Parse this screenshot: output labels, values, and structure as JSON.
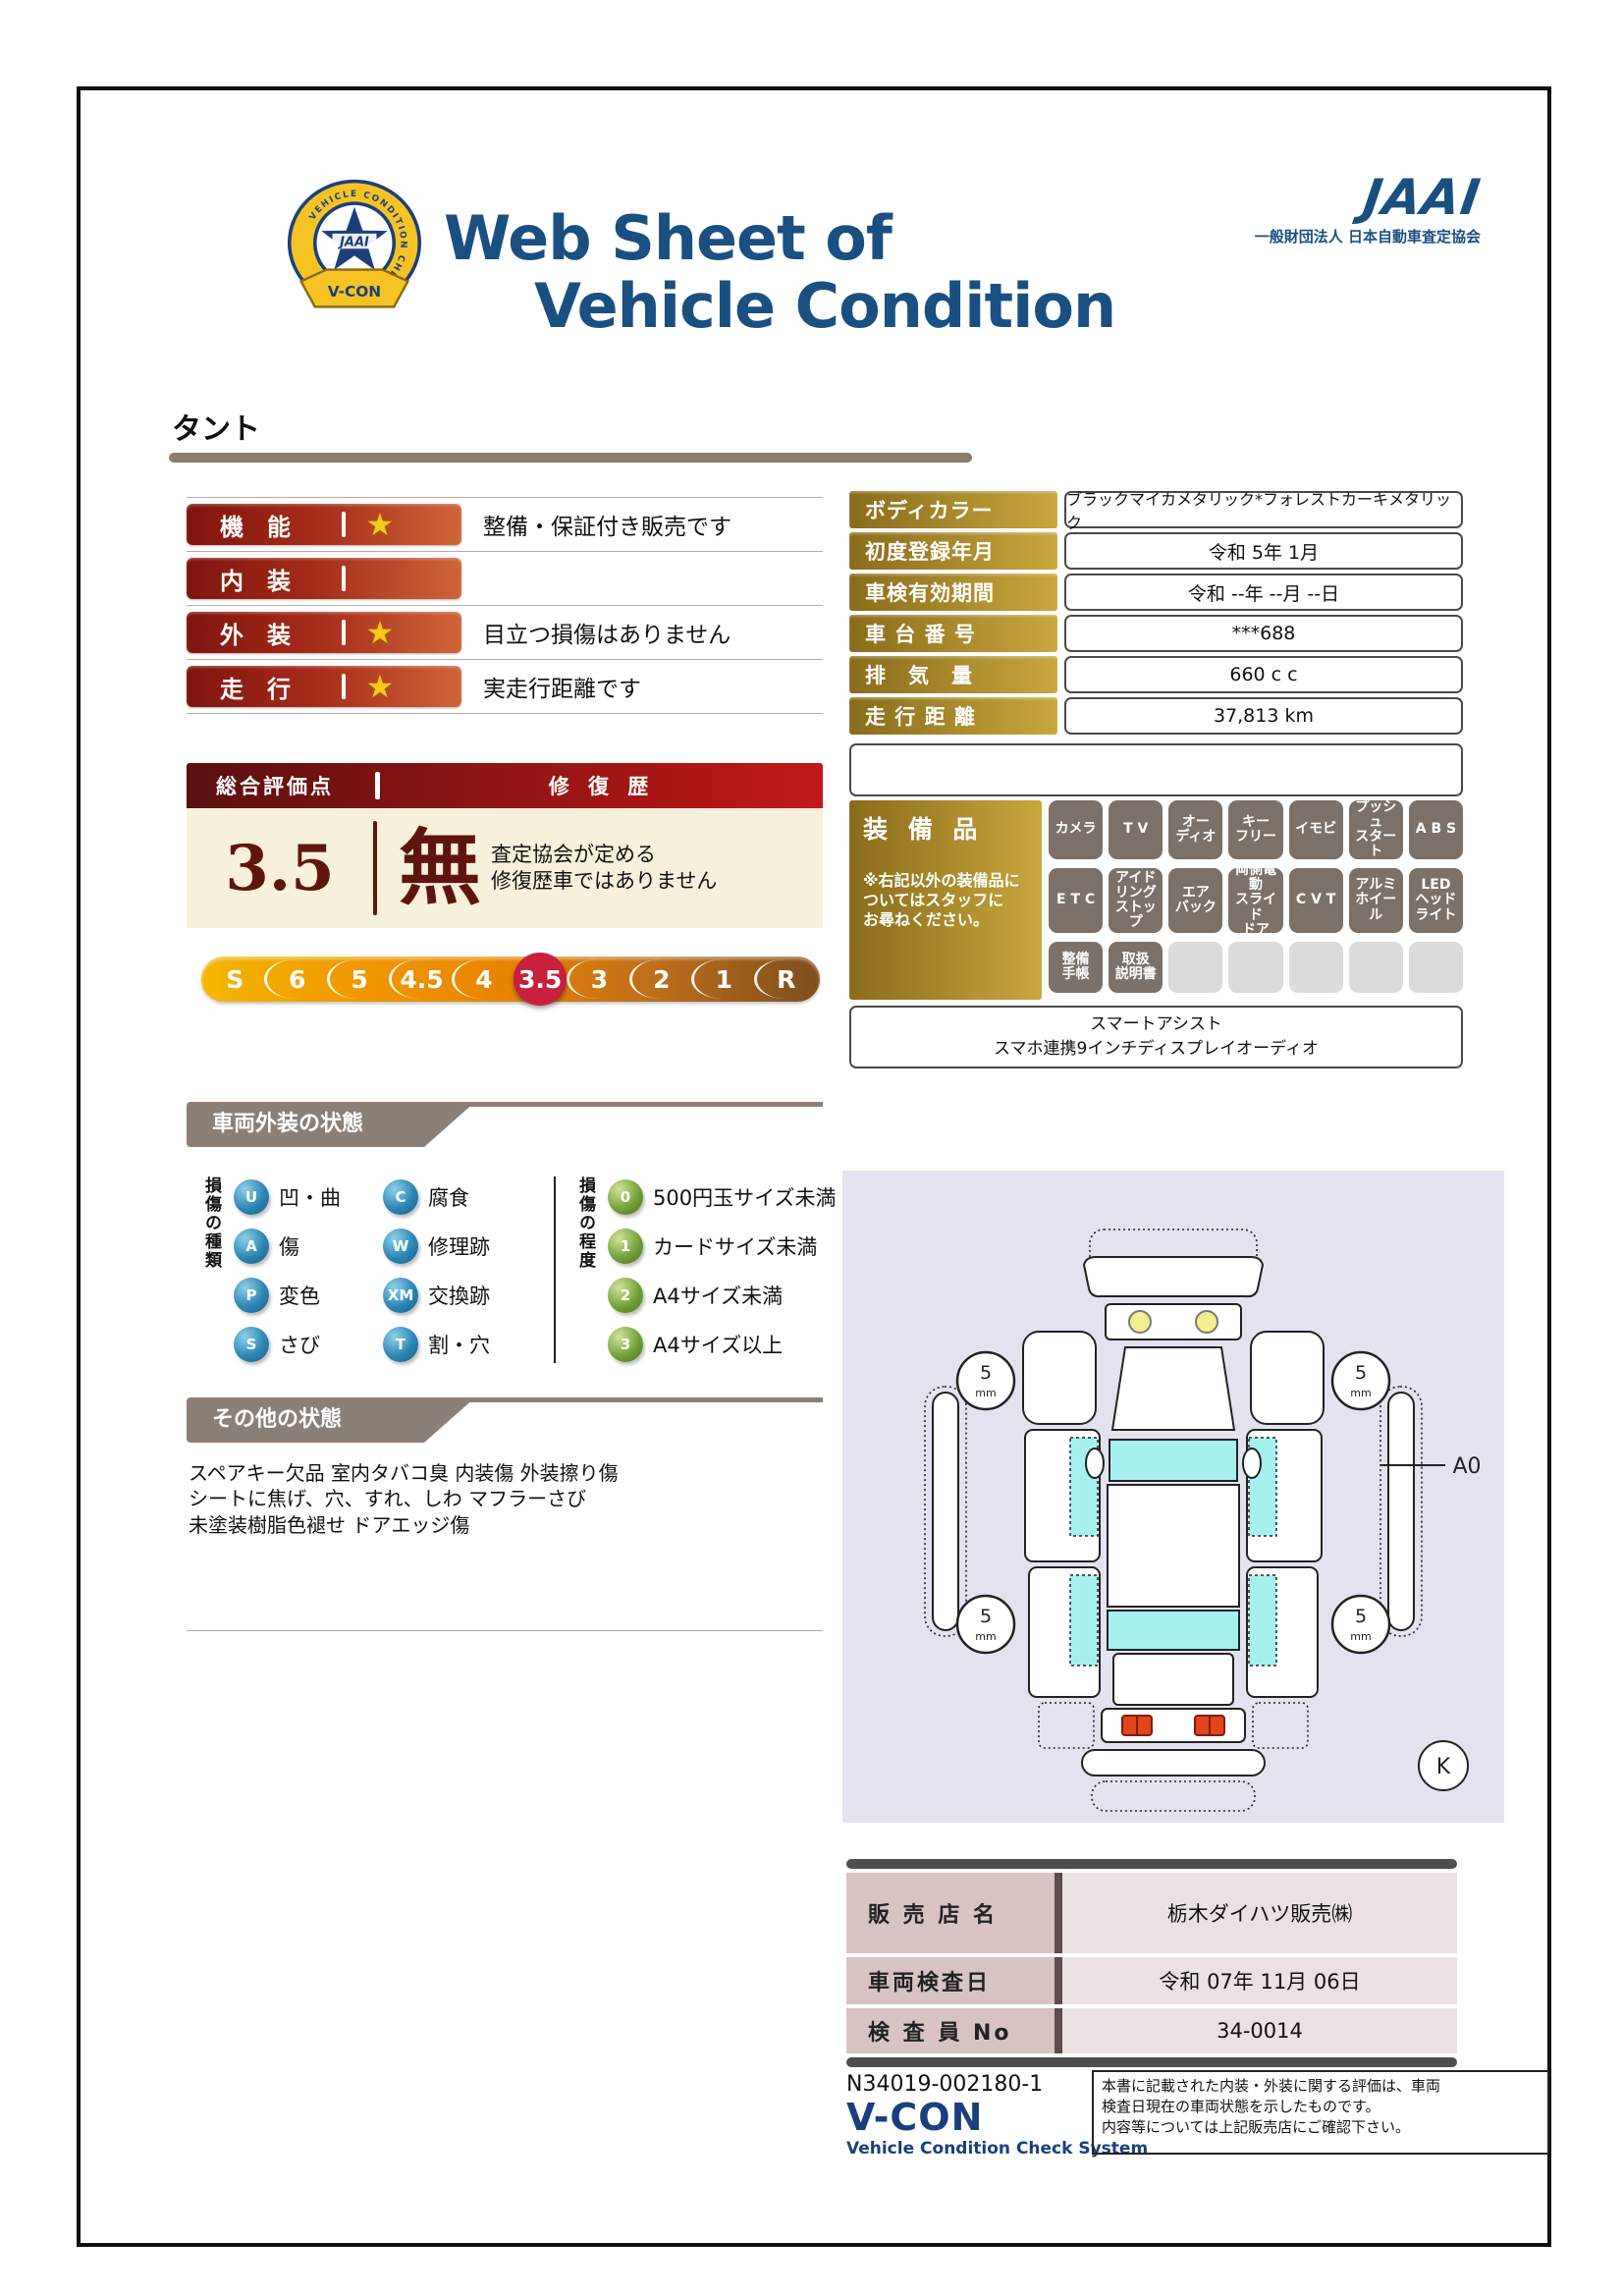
{
  "header": {
    "title_line1": "Web Sheet of",
    "title_line2": "Vehicle Condition",
    "vcon_badge": {
      "jaai": "JAAI",
      "ring_text": "VEHICLE CONDITION CHECK SYSTEM",
      "ribbon": "V-CON"
    },
    "jaai_wordmark": "JAAI",
    "jaai_org": "一般財団法人 日本自動車査定協会"
  },
  "vehicle_name": "タント",
  "ratings": [
    {
      "label": "機　能",
      "star": true,
      "note": "整備・保証付き販売です"
    },
    {
      "label": "内　装",
      "star": false,
      "note": ""
    },
    {
      "label": "外　装",
      "star": true,
      "note": "目立つ損傷はありません"
    },
    {
      "label": "走　行",
      "star": true,
      "note": "実走行距離です"
    }
  ],
  "overall": {
    "header_left": "総合評価点",
    "header_right": "修 復 歴",
    "score": "3.5",
    "repair_mark": "無",
    "repair_note_line1": "査定協会が定める",
    "repair_note_line2": "修復歴車ではありません"
  },
  "scale": {
    "items": [
      {
        "label": "S"
      },
      {
        "label": "6"
      },
      {
        "label": "5"
      },
      {
        "label": "4.5"
      },
      {
        "label": "4"
      },
      {
        "label": "3.5",
        "selected": true
      },
      {
        "label": "3"
      },
      {
        "label": "2"
      },
      {
        "label": "1"
      },
      {
        "label": "R"
      }
    ]
  },
  "info_table": {
    "rows": [
      {
        "label": "ボディカラー",
        "value": "ブラックマイカメタリック*フォレストカーキメタリック"
      },
      {
        "label": "初度登録年月",
        "value": "令和 5年 1月"
      },
      {
        "label": "車検有効期間",
        "value": "令和 --年 --月 --日"
      },
      {
        "label": "車 台 番 号",
        "value": "***688"
      },
      {
        "label": "排　気　量",
        "value": "660 c c"
      },
      {
        "label": "走 行 距 離",
        "value": "37,813 km"
      }
    ]
  },
  "equipment": {
    "title": "装 備 品",
    "note": "※右記以外の装備品に\nついてはスタッフに\nお尋ねください。",
    "badges": [
      {
        "label": "カメラ",
        "active": true
      },
      {
        "label": "T V",
        "active": true
      },
      {
        "label": "オー\nディオ",
        "active": true
      },
      {
        "label": "キー\nフリー",
        "active": true
      },
      {
        "label": "イモビ",
        "active": true
      },
      {
        "label": "プッシュ\nスタート",
        "active": true
      },
      {
        "label": "A B S",
        "active": true
      },
      {
        "label": "E T C",
        "active": true
      },
      {
        "label": "アイド\nリング\nストップ",
        "active": true
      },
      {
        "label": "エア\nバック",
        "active": true
      },
      {
        "label": "両側電動\nスライド\nドア",
        "active": true
      },
      {
        "label": "C V T",
        "active": true
      },
      {
        "label": "アルミ\nホイール",
        "active": true
      },
      {
        "label": "LED\nヘッド\nライト",
        "active": true
      },
      {
        "label": "整備\n手帳",
        "active": true
      },
      {
        "label": "取扱\n説明書",
        "active": true
      },
      {
        "label": "",
        "active": false
      },
      {
        "label": "",
        "active": false
      },
      {
        "label": "",
        "active": false
      },
      {
        "label": "",
        "active": false
      },
      {
        "label": "",
        "active": false
      }
    ],
    "extra_line1": "スマートアシスト",
    "extra_line2": "スマホ連携9インチディスプレイオーディオ"
  },
  "exterior": {
    "section_title": "車両外装の状態",
    "type_axis": "損傷の種類",
    "types": [
      {
        "code": "U",
        "label": "凹・曲"
      },
      {
        "code": "C",
        "label": "腐食"
      },
      {
        "code": "A",
        "label": "傷"
      },
      {
        "code": "W",
        "label": "修理跡"
      },
      {
        "code": "P",
        "label": "変色"
      },
      {
        "code": "XM",
        "label": "交換跡"
      },
      {
        "code": "S",
        "label": "さび"
      },
      {
        "code": "T",
        "label": "割・穴"
      }
    ],
    "degree_axis": "損傷の程度",
    "degrees": [
      {
        "code": "0",
        "label": "500円玉サイズ未満"
      },
      {
        "code": "1",
        "label": "カードサイズ未満"
      },
      {
        "code": "2",
        "label": "A4サイズ未満"
      },
      {
        "code": "3",
        "label": "A4サイズ以上"
      }
    ]
  },
  "other": {
    "section_title": "その他の状態",
    "lines": [
      "スペアキー欠品 室内タバコ臭 内装傷 外装擦り傷",
      "シートに焦げ、穴、すれ、しわ マフラーさび",
      "未塗装樹脂色褪せ ドアエッジ傷"
    ]
  },
  "diagram": {
    "tire_size": "5",
    "tire_unit": "mm",
    "damage_marker": "A0",
    "key_mark": "K"
  },
  "dealer": {
    "rows": [
      {
        "label": "販 売 店 名",
        "value": "栃木ダイハツ販売㈱"
      },
      {
        "label": "車両検査日",
        "value": "令和 07年 11月 06日"
      },
      {
        "label": "検 査 員 No",
        "value": "34-0014"
      }
    ]
  },
  "footer": {
    "doc_number": "N34019-002180-1",
    "vcon": "V-CON",
    "vcon_sub": "Vehicle Condition Check System",
    "disclaimer": "本書に記載された内装・外装に関する評価は、車両\n検査日現在の車両状態を示したものです。\n内容等については上記販売店にご確認下さい。"
  },
  "colors": {
    "navy": "#1a4f82",
    "maroon": "#7f150e",
    "gold": "#8a6b1a",
    "crimson": "#c8203d",
    "taupe": "#8b8078",
    "cream": "#f7f0da"
  }
}
